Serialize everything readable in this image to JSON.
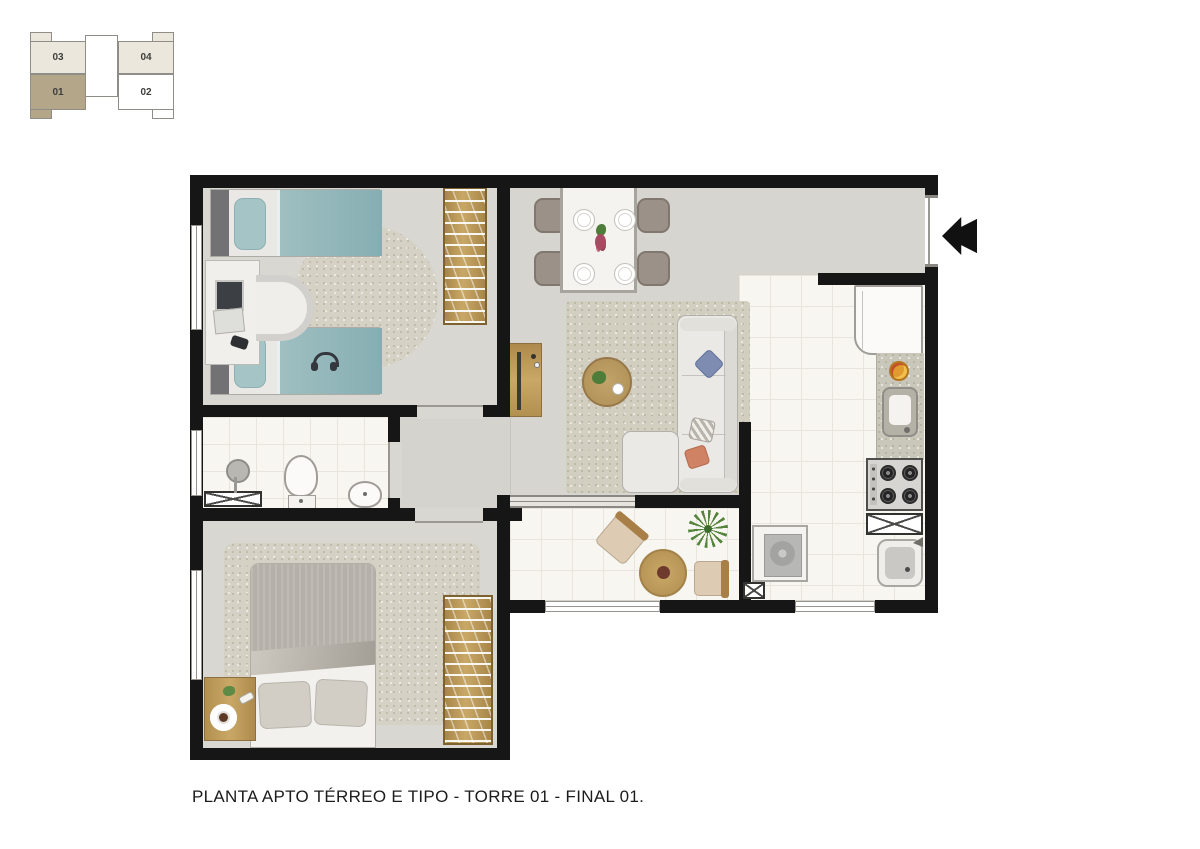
{
  "locator": {
    "units": [
      {
        "id": "03",
        "selected": false
      },
      {
        "id": "04",
        "selected": false
      },
      {
        "id": "01",
        "selected": true
      },
      {
        "id": "02",
        "selected": false
      }
    ],
    "selected_unit": "01"
  },
  "caption": "PLANTA APTO TÉRREO E TIPO - TORRE 01 - FINAL 01.",
  "colors": {
    "wall": "#161616",
    "unit_selected": "#b3a689",
    "unit_light": "#ebe7dc",
    "bed_teal": "#8fb6ba",
    "wood": "#b8965a",
    "entrance_arrow": "#111111"
  }
}
